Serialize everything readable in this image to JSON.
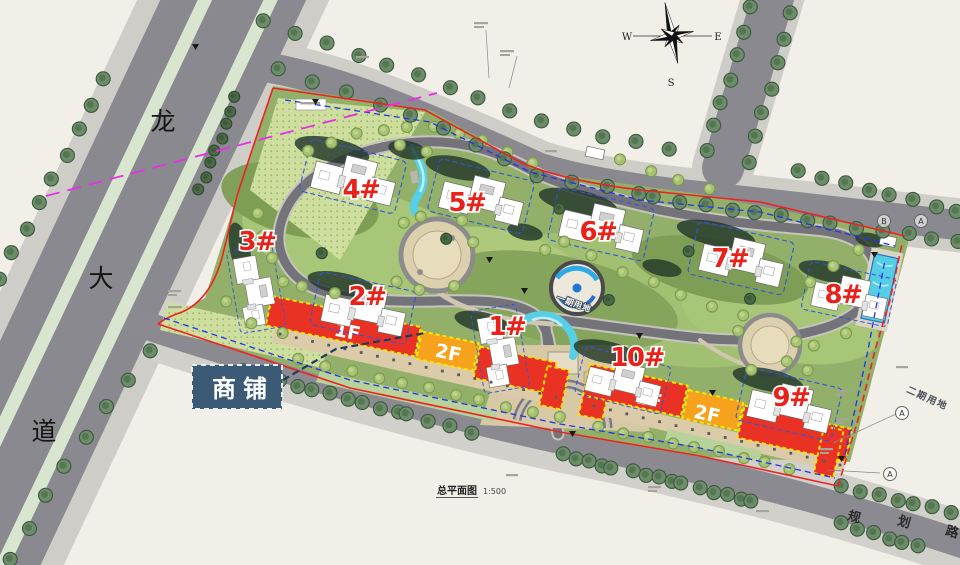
{
  "drawing": {
    "scale_title": "总平面图",
    "scale_ratio": "1:500",
    "compass": {
      "west": "W",
      "east": "E",
      "south": "S"
    },
    "roads": {
      "west_avenue": {
        "chars": [
          "龙",
          "大",
          "道"
        ]
      },
      "planned_road": {
        "chars": [
          "规",
          "划",
          "路"
        ]
      }
    },
    "parcels": {
      "phase1": "一期用地",
      "phase2": "二期用地"
    },
    "callout": {
      "shops": "商铺"
    },
    "buildings": [
      {
        "label": "3#"
      },
      {
        "label": "4#"
      },
      {
        "label": "5#"
      },
      {
        "label": "6#"
      },
      {
        "label": "7#"
      },
      {
        "label": "8#"
      },
      {
        "label": "2#"
      },
      {
        "label": "1#"
      },
      {
        "label": "10#"
      },
      {
        "label": "9#"
      }
    ],
    "commercial": {
      "strip_west": {
        "floor1": "1F",
        "floor2": "2F"
      },
      "strip_east": {
        "floor1": "1F",
        "floor2": "2F"
      }
    },
    "grid_markers": [
      {
        "label": "B"
      },
      {
        "label": "A"
      },
      {
        "label": "A"
      },
      {
        "label": "A"
      }
    ],
    "colors": {
      "commercial_red": "#e93223",
      "commercial_orange": "#f6a21c",
      "outline_yellow": "#ffe400",
      "boundary_red": "#ee2222",
      "boundary_blue": "#2233ee",
      "boundary_magenta": "#e62ee6",
      "callout_bg": "#3b5a75",
      "label_red": "#e8221a"
    }
  }
}
